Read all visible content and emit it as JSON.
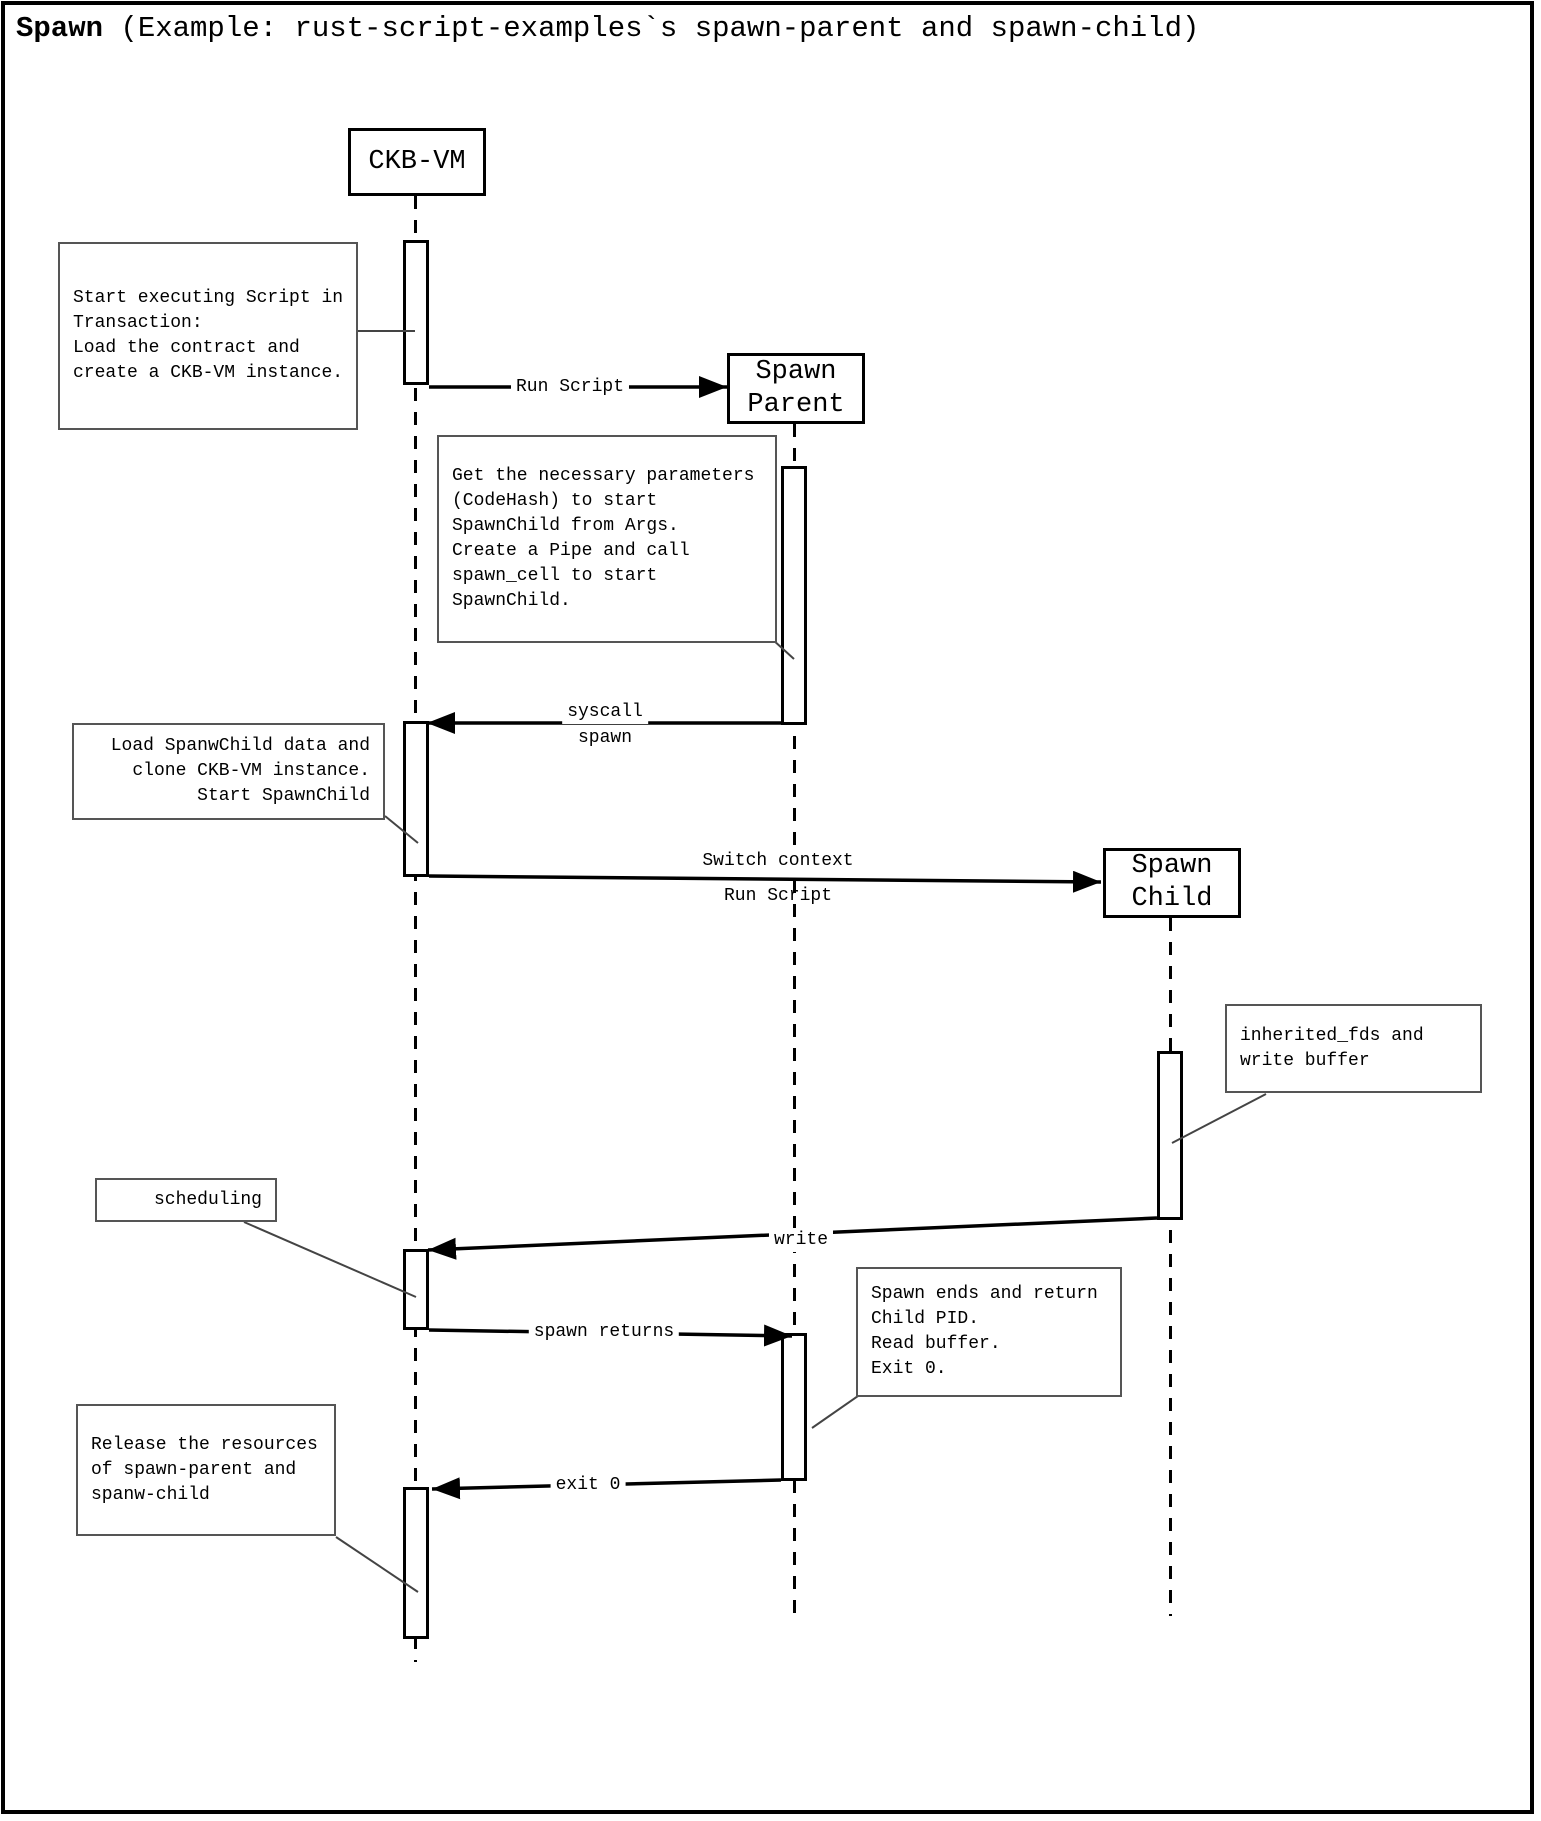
{
  "title": {
    "bold": "Spawn",
    "rest": " (Example: rust-script-examples`s spawn-parent and spawn-child)"
  },
  "actors": {
    "ckb_vm": {
      "label": "CKB-VM"
    },
    "spawn_parent": {
      "line1": "Spawn",
      "line2": "Parent"
    },
    "spawn_child": {
      "line1": "Spawn",
      "line2": "Child"
    }
  },
  "messages": {
    "run_script": {
      "label": "Run Script"
    },
    "syscall_spawn": {
      "line1": "syscall",
      "line2": "spawn"
    },
    "switch_context": {
      "line1": "Switch context",
      "line2": "Run Script"
    },
    "write": {
      "label": "write"
    },
    "spawn_returns": {
      "label": "spawn returns"
    },
    "exit0": {
      "label": "exit 0"
    }
  },
  "notes": {
    "start_executing": {
      "lines": [
        "Start executing Script in",
        "Transaction:",
        "Load the contract and",
        "create a CKB-VM instance."
      ]
    },
    "get_parameters": {
      "lines": [
        "Get the necessary parameters",
        "(CodeHash) to start",
        "SpawnChild from Args.",
        "Create a Pipe and call",
        "spawn_cell to start",
        "SpawnChild."
      ]
    },
    "load_spawnchild": {
      "lines": [
        "Load SpanwChild data and",
        "clone CKB-VM instance.",
        "Start SpawnChild"
      ]
    },
    "inherited_fds": {
      "lines": [
        "inherited_fds and",
        "write buffer"
      ]
    },
    "scheduling": {
      "lines": [
        "scheduling"
      ]
    },
    "spawn_ends": {
      "lines": [
        "Spawn ends and return",
        "Child PID.",
        "Read buffer.",
        "Exit 0."
      ]
    },
    "release_resources": {
      "lines": [
        "Release the resources",
        "of spawn-parent and",
        "spanw-child"
      ]
    }
  },
  "colors": {
    "line": "#000000",
    "note_border": "#555555",
    "background": "#ffffff"
  }
}
